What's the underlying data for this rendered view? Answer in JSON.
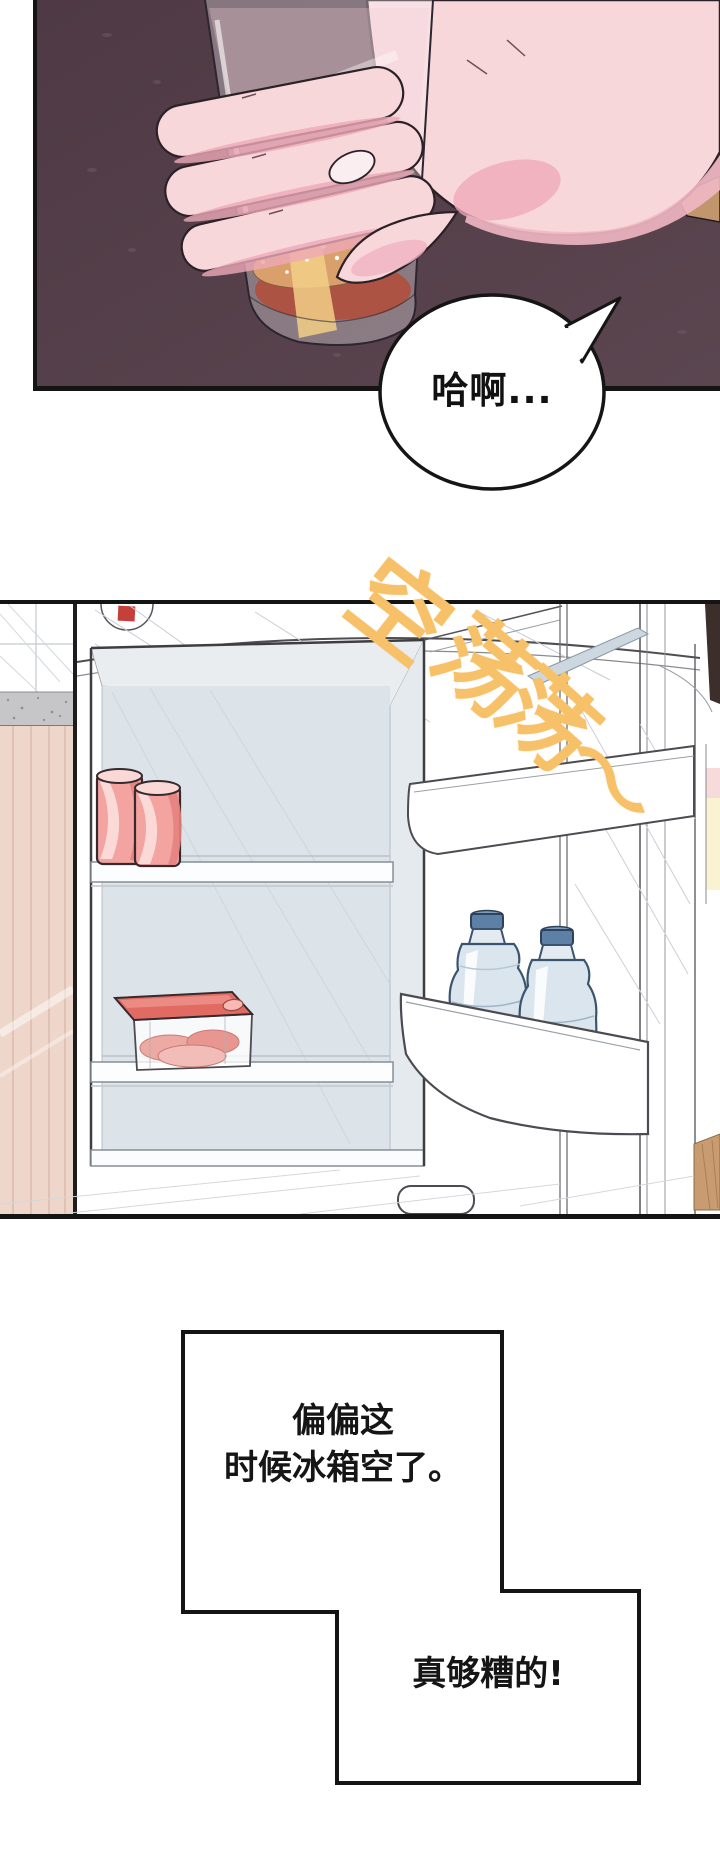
{
  "page": {
    "width": 720,
    "height": 1855,
    "background": "#ffffff"
  },
  "panel_drink": {
    "background_color": "#56424e",
    "bubble_text": "哈啊..."
  },
  "panel_fridge": {
    "interior_color": "#dde4e9",
    "logo_mark_color": "#c5403a",
    "sfx_color": "#f6c169",
    "sfx_glyphs": [
      "空",
      "荡",
      "荡",
      "〜"
    ]
  },
  "captions": {
    "box1_line1": "偏偏这",
    "box1_line2": "时候冰箱空了。",
    "box2_text": "真够糟的!"
  }
}
